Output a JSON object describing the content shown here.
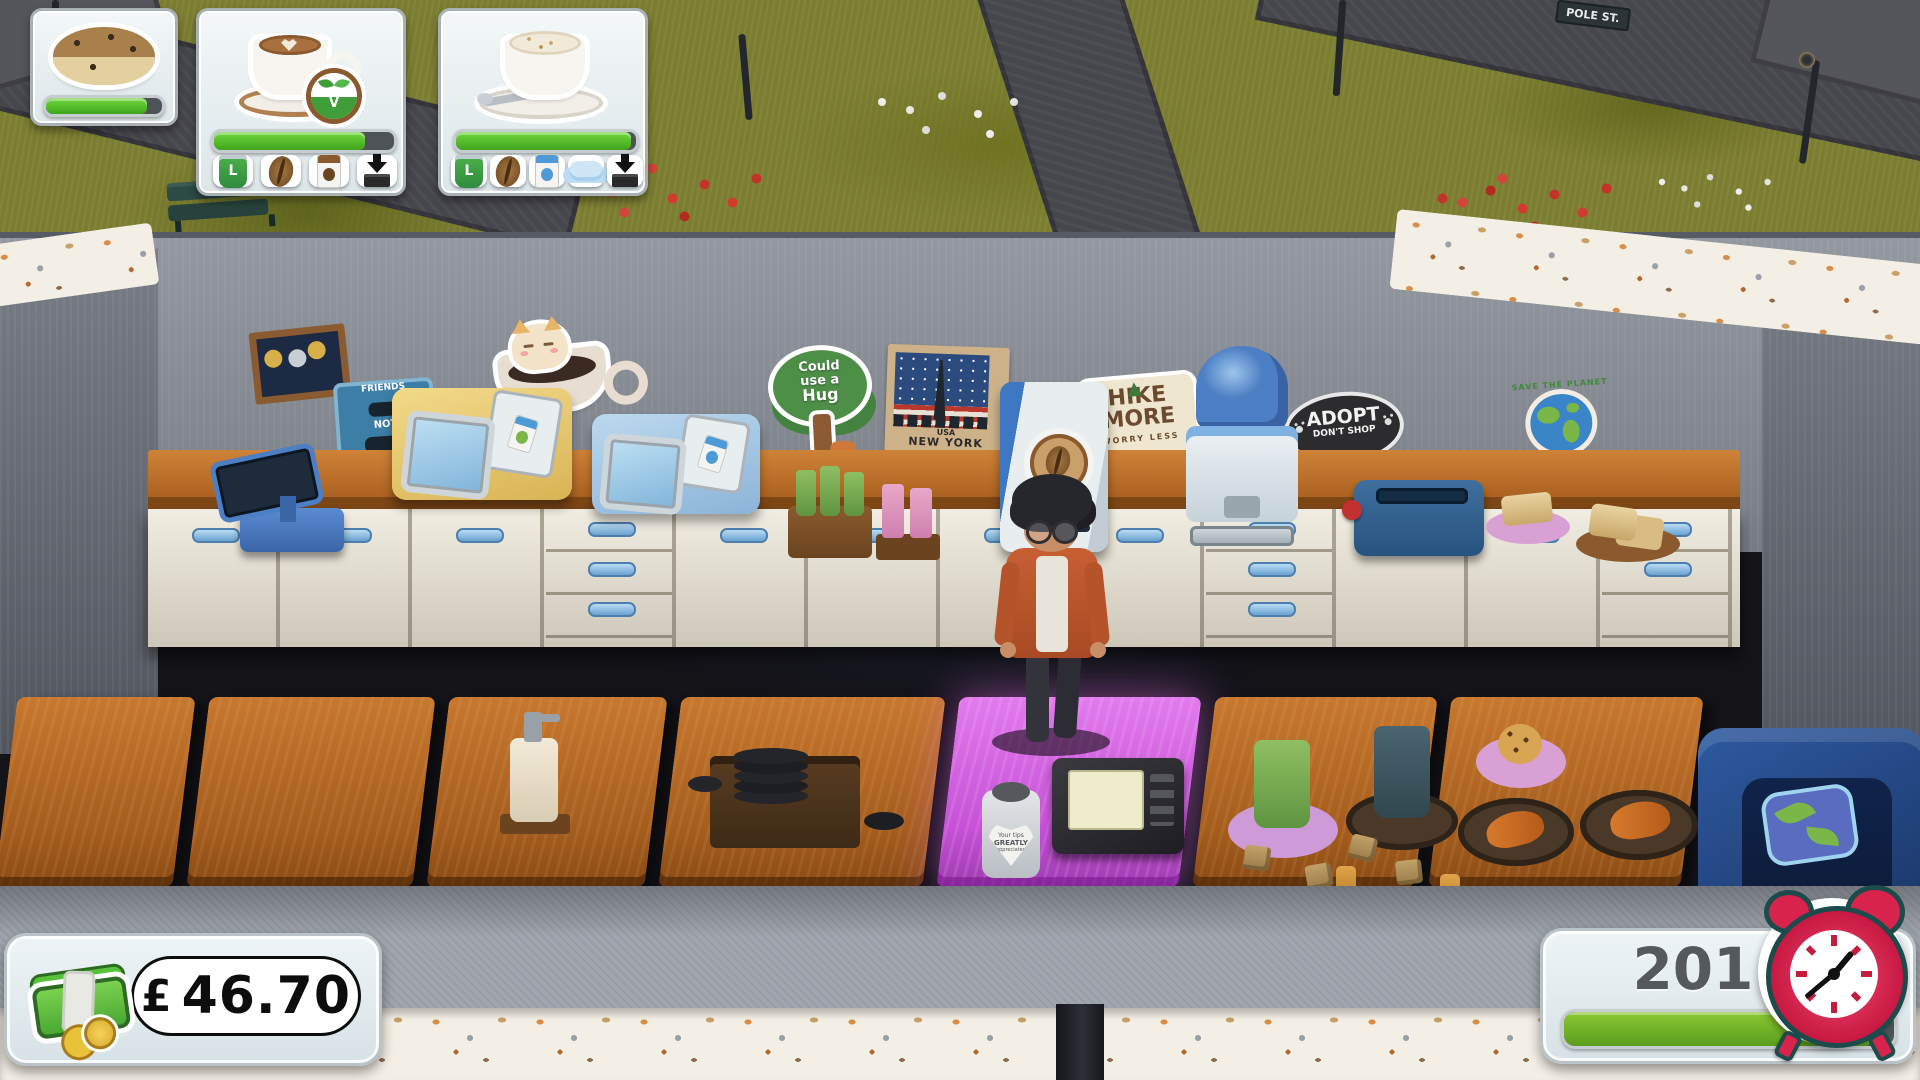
{
  "hud": {
    "size_label": "L",
    "vegan_label": "V",
    "orders": [
      {
        "item": "chocolate-chip-scone",
        "progress": 87,
        "ingredients": []
      },
      {
        "item": "vegan-latte",
        "progress": 84,
        "ingredients": [
          "large-cup",
          "coffee-beans",
          "oat-milk",
          "tamp-press"
        ]
      },
      {
        "item": "cappuccino",
        "progress": 97,
        "ingredients": [
          "large-cup",
          "coffee-beans",
          "milk",
          "milk-froth",
          "tamp-press"
        ]
      }
    ],
    "money": {
      "currency_symbol": "£",
      "amount": "46.70"
    },
    "timer": {
      "value": "201",
      "progress": 93
    }
  },
  "scene": {
    "street_sign": "POLE ST.",
    "wall_stickers": {
      "hug_tree": {
        "line1": "Could",
        "line2": "use a",
        "line3": "Hug"
      },
      "new_york_poster": {
        "country": "USA",
        "city": "NEW YORK"
      },
      "hike_more": {
        "line1": "HIKE",
        "line2": "MORE",
        "line3": "WORRY LESS"
      },
      "adopt": {
        "line1": "ADOPT",
        "line2": "DON'T SHOP"
      },
      "save_planet": {
        "text": "SAVE THE PLANET"
      },
      "friends_not_food": {
        "line1": "FRIENDS",
        "line2": "NOT",
        "line3": "FOOD"
      }
    },
    "tip_jar": {
      "line1": "Your tips",
      "line2": "GREATLY",
      "line3": "appreciated"
    }
  }
}
